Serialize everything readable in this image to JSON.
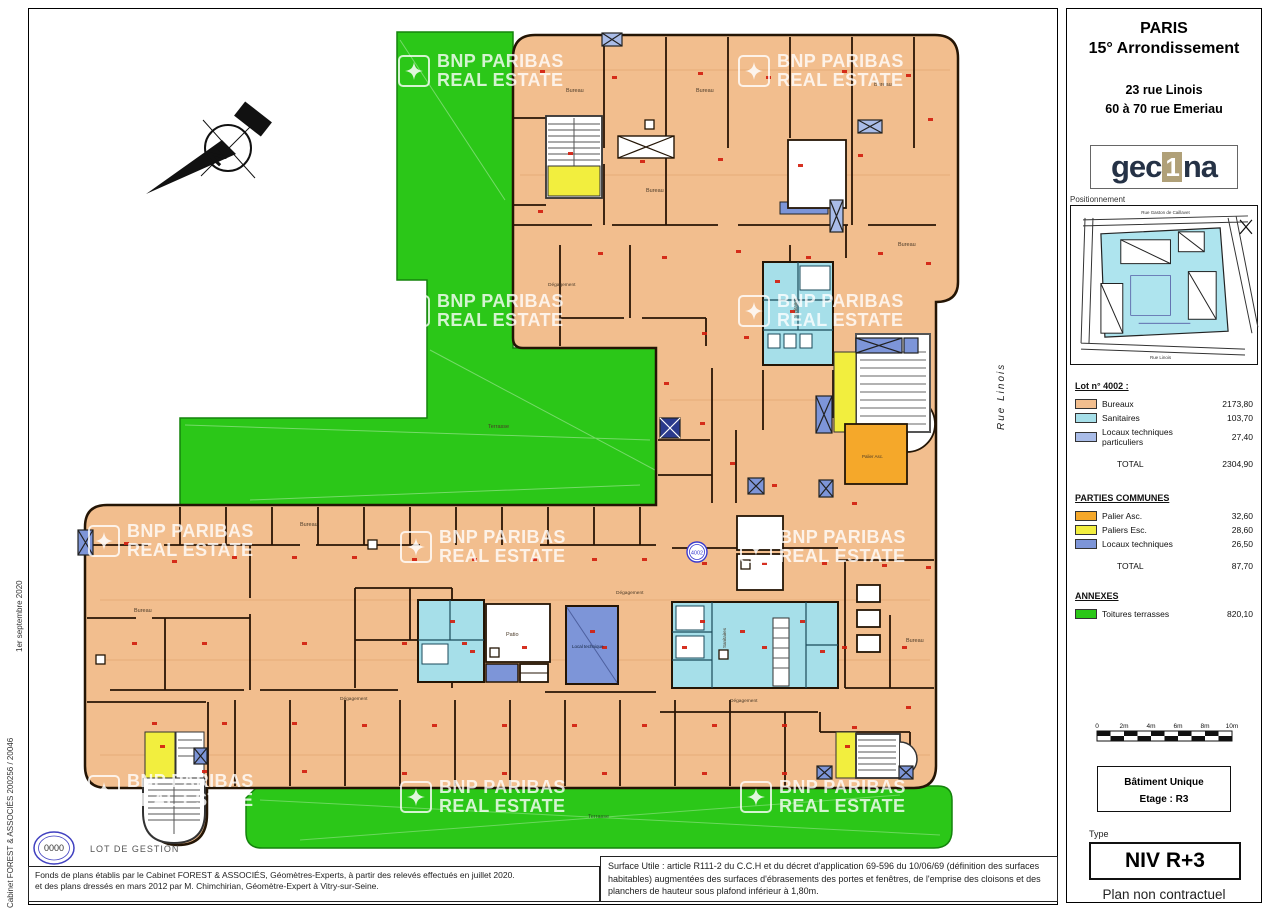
{
  "header": {
    "city": "PARIS",
    "district": "15° Arrondissement",
    "address_line1": "23 rue Linois",
    "address_line2": "60 à 70 rue Emeriau",
    "logo_left": "gec",
    "logo_one": "1",
    "logo_right": "na",
    "positionnement_label": "Positionnement"
  },
  "site_map": {
    "street_top": "Rue Gaston de Caillavet",
    "street_bottom": "Rue Linois"
  },
  "legend": {
    "lot_title": "Lot n° 4002 :",
    "lot_rows": [
      {
        "label": "Bureaux",
        "value": "2173,80",
        "color": "#f2be8e"
      },
      {
        "label": "Sanitaires",
        "value": "103,70",
        "color": "#a6dfe9"
      },
      {
        "label": "Locaux techniques particuliers",
        "value": "27,40",
        "color": "#a9bce8"
      }
    ],
    "lot_total_label": "TOTAL",
    "lot_total": "2304,90",
    "communes_title": "PARTIES COMMUNES",
    "communes_rows": [
      {
        "label": "Palier Asc.",
        "value": "32,60",
        "color": "#f5a82a"
      },
      {
        "label": "Paliers Esc.",
        "value": "28,60",
        "color": "#f2ee3e"
      },
      {
        "label": "Locaux techniques",
        "value": "26,50",
        "color": "#7d95d8"
      }
    ],
    "communes_total_label": "TOTAL",
    "communes_total": "87,70",
    "annexes_title": "ANNEXES",
    "annexes_rows": [
      {
        "label": "Toitures terrasses",
        "value": "820,10",
        "color": "#2bc718"
      }
    ]
  },
  "scale_bar": {
    "ticks": [
      "0",
      "2m",
      "4m",
      "6m",
      "8m",
      "10m"
    ]
  },
  "building_box": {
    "line1": "Bâtiment Unique",
    "line2": "Etage : R3"
  },
  "type_label": "Type",
  "level": "NIV R+3",
  "disclaimer": "Plan non contractuel",
  "footer": {
    "left_line1": "Fonds de plans établis par le Cabinet FOREST & ASSOCIÉS, Géomètres-Experts, à partir des relevés effectués en juillet 2020.",
    "left_line2": "et des plans dressés en mars 2012 par M. Chimchirian, Géomètre-Expert à Vitry-sur-Seine.",
    "surface_note": "Surface Utile : article R111-2 du C.C.H et du décret d'application 69-596 du 10/06/69 (définition des surfaces habitables) augmentées des surfaces d'ébrasements des portes et fenêtres, de l'emprise des cloisons et des planchers de hauteur sous plafond inférieur à 1,80m."
  },
  "margin": {
    "date": "1er septembre 2020",
    "cabinet": "Cabinet FOREST & ASSOCIÉS 200256 / 20046"
  },
  "lot_gestion": {
    "badge": "0000",
    "label": "LOT DE GESTION"
  },
  "plan": {
    "north": "N",
    "lot_badge": "4002",
    "street_label": "Rue Linois",
    "labels": {
      "terrasse": "Terrasse",
      "patio": "Patio",
      "bureau": "Bureau",
      "degagement": "Dégagement",
      "sanitaires": "Sanitaires",
      "local_technique": "Local technique",
      "palier_asc": "Palier Asc."
    }
  },
  "watermark": {
    "line1": "BNP PARIBAS",
    "line2": "REAL ESTATE"
  }
}
